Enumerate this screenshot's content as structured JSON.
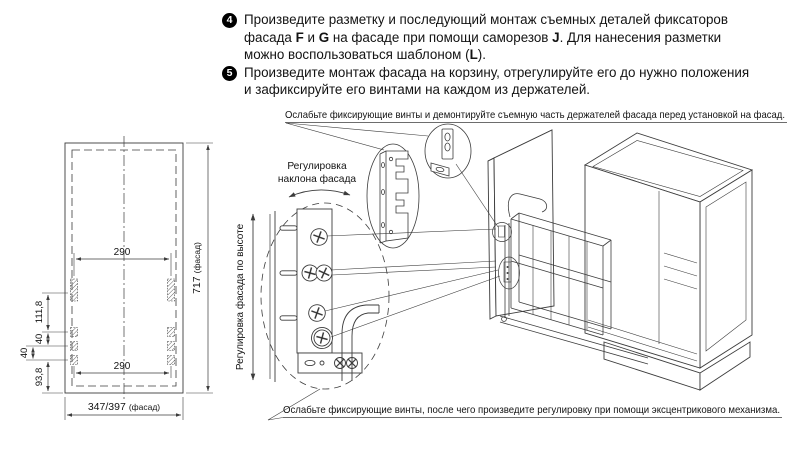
{
  "colors": {
    "background": "#ffffff",
    "line": "#3c3c3c",
    "text": "#131313",
    "badge": "#000000"
  },
  "instructions": {
    "steps": [
      {
        "number": "4",
        "parts": [
          {
            "t": "Произведите разметку и последующий монтаж съемных деталей фиксаторов"
          },
          {
            "t": "фасада "
          },
          {
            "t": "F",
            "b": true
          },
          {
            "t": " и "
          },
          {
            "t": "G",
            "b": true
          },
          {
            "t": " на фасаде при помощи саморезов "
          },
          {
            "t": "J",
            "b": true
          },
          {
            "t": ". Для нанесения разметки"
          },
          {
            "t": "можно воспользоваться шаблоном ("
          },
          {
            "t": "L",
            "b": true
          },
          {
            "t": ")."
          }
        ]
      },
      {
        "number": "5",
        "parts": [
          {
            "t": "Произведите монтаж фасада на корзину, отрегулируйте его до нужно положения"
          },
          {
            "t": "и зафиксируйте его винтами на каждом из держателей."
          }
        ]
      }
    ]
  },
  "callouts": {
    "top": "Ослабьте фиксирующие винты и демонтируйте съемную часть держателей фасада перед установкой на фасад.",
    "bottom": "Ослабьте фиксирующие винты, после чего произведите регулировку при помощи эксцентрикового механизма."
  },
  "facade_drawing": {
    "dim_top": "290",
    "dim_bottom": "290",
    "dim_height_value": "717",
    "dim_height_suffix": "(фасад)",
    "dim_width_value": "347/397",
    "dim_width_suffix": "(фасад)",
    "dim_offsets": [
      "111,8",
      "40",
      "40",
      "93,8"
    ]
  },
  "labels": {
    "tilt_line1": "Регулировка",
    "tilt_line2": "наклона фасада",
    "height": "Регулировка фасада по высоте"
  }
}
